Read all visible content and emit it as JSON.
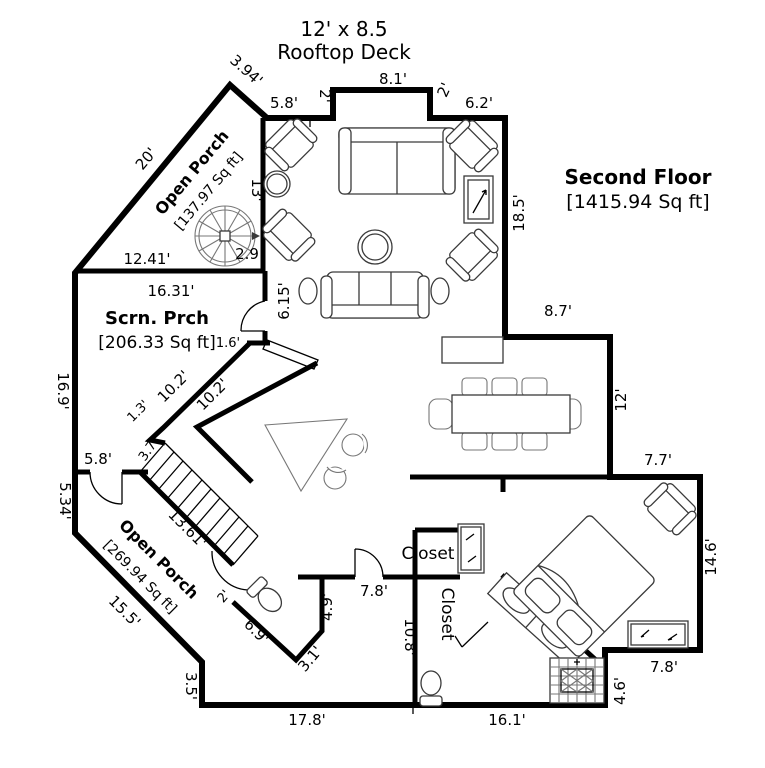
{
  "header": {
    "deck_size": "12' x 8.5",
    "deck_name": "Rooftop Deck"
  },
  "floor": {
    "name": "Second Floor",
    "area": "[1415.94 Sq ft]"
  },
  "rooms": {
    "open_porch_upper": {
      "name": "Open Porch",
      "area": "[137.97 Sq ft]"
    },
    "screened_porch": {
      "name": "Scrn. Prch",
      "area": "[206.33 Sq ft]"
    },
    "open_porch_lower": {
      "name": "Open Porch",
      "area": "[269.94 Sq ft]"
    },
    "closet_upper": {
      "name": "Closet"
    },
    "closet_lower": {
      "name": "Closet"
    }
  },
  "dimensions": {
    "deck_left_diag": "3.94'",
    "deck_left": "5.8'",
    "deck_step_left": "2'",
    "deck_top": "8.1'",
    "deck_step_right": "2'",
    "deck_right": "6.2'",
    "living_right": "18.5'",
    "dining_top": "8.7'",
    "dining_right": "12'",
    "bedroom_top": "7.7'",
    "bedroom_right": "14.6'",
    "bedroom_bottom": "7.8'",
    "bedroom_step": "4.6'",
    "bottom_right": "16.1'",
    "bottom_left": "17.8'",
    "porch_hypotenuse": "20'",
    "porch_side": "13'",
    "spiral_stair": "2.9",
    "porch_bottom": "12.41'",
    "scrn_top": "16.31'",
    "scrn_door_wall": "6.15'",
    "scrn_jog": "1.6'",
    "scrn_left": "16.9'",
    "hall_diag_upper": "10.2'",
    "hall_diag_lower": "10.2'",
    "jog_small": "1.3'",
    "jog_large": "3.7'",
    "porch_door": "5.8'",
    "porch_left": "5.34'",
    "stairs": "13.61'",
    "porch_diag": "15.5'",
    "porch_step": "3.5'",
    "bath_door": "2'",
    "bath_diag": "6.9'",
    "bath_side": "3.1'",
    "hall_side": "4.9'",
    "hall_width": "7.8'",
    "bath_wall": "10.8'"
  }
}
